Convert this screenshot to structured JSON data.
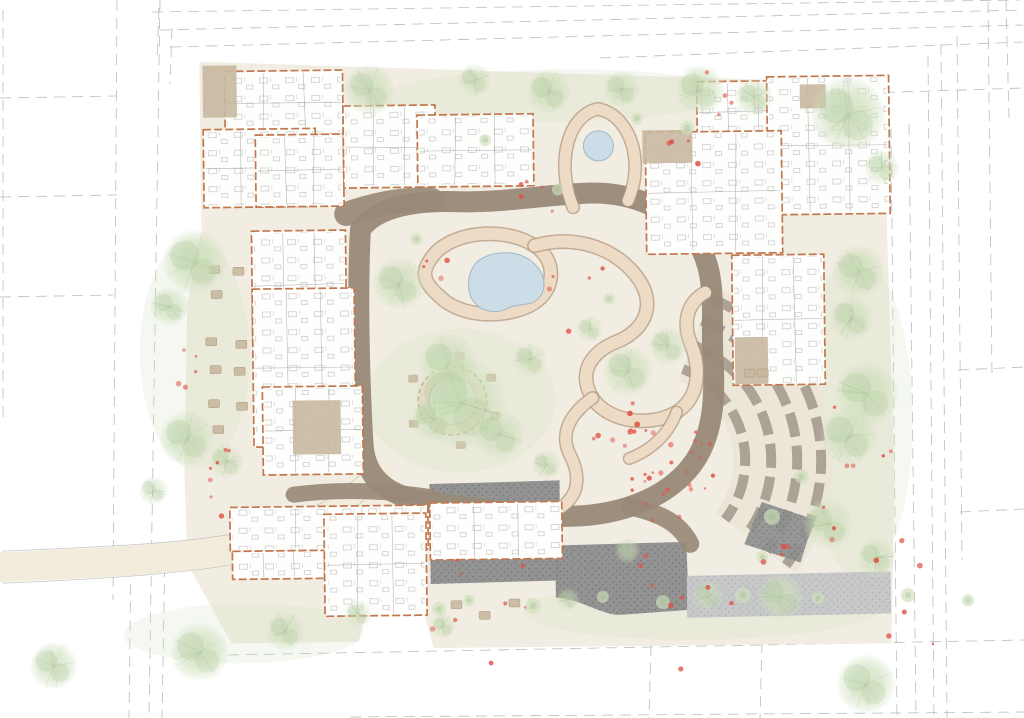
{
  "meta": {
    "description": "Watercolor landscape architecture site plan of a care-home campus with central therapeutic garden",
    "canvas": {
      "width": 1024,
      "height": 718
    }
  },
  "palette": {
    "background": "#ffffff",
    "site_ground": "#f1ece0",
    "ground_wash_green": "#cfe0bf",
    "main_path_brown": "#998977",
    "garden_path_fill": "#eddbc5",
    "garden_path_edge": "#b2957c",
    "building_fill": "#fefefd",
    "building_wall_orange": "#c1784e",
    "patio_tan": "#c8b8a0",
    "water_fill": "#ccdde8",
    "water_edge": "#9db7c6",
    "tree_green": "#cfe0bd",
    "tree_accent": "#9fbe8c",
    "paving_dark": "#8d8e8e",
    "paving_speck": "#5c5c5a",
    "paving_light": "#c5c6c8",
    "terrace_stripe": "#a2958a",
    "terrace_band": "#ece6d9",
    "flower_red": "#e05248",
    "boundary_line": "#a9adad",
    "furniture_line": "#9a9a9a",
    "road_fill": "#f2ecdc",
    "road_edge": "#b8b8b8"
  },
  "site_plan": {
    "boundary_lines": [
      [
        3,
        10,
        3,
        420
      ],
      [
        117,
        0,
        113,
        600
      ],
      [
        160,
        0,
        149,
        718
      ],
      [
        131,
        548,
        129,
        718
      ],
      [
        165,
        548,
        162,
        718
      ],
      [
        0,
        98,
        117,
        96
      ],
      [
        0,
        197,
        117,
        195
      ],
      [
        0,
        297,
        113,
        295
      ],
      [
        152,
        12,
        1020,
        0
      ],
      [
        160,
        30,
        1023,
        10
      ],
      [
        170,
        47,
        1023,
        25
      ],
      [
        600,
        58,
        1023,
        42
      ],
      [
        776,
        96,
        1023,
        88
      ],
      [
        159,
        8,
        157,
        62
      ],
      [
        172,
        28,
        170,
        84
      ],
      [
        891,
        128,
        897,
        718
      ],
      [
        909,
        124,
        916,
        718
      ],
      [
        928,
        56,
        934,
        718
      ],
      [
        941,
        44,
        947,
        718
      ],
      [
        957,
        36,
        962,
        560
      ],
      [
        988,
        2,
        992,
        376
      ],
      [
        1006,
        0,
        1009,
        118
      ],
      [
        958,
        370,
        1024,
        367
      ],
      [
        960,
        512,
        1024,
        509
      ],
      [
        228,
        655,
        1024,
        640
      ],
      [
        350,
        717,
        1024,
        712
      ],
      [
        651,
        645,
        649,
        718
      ],
      [
        762,
        642,
        760,
        718
      ]
    ],
    "ground": {
      "site_polygon": "203,58 886,88 893,478 888,648 430,647 418,600 368,595 355,640 228,640 185,560 183,470 188,300 203,230",
      "road": {
        "fill_path": "M 0,561 C 92,558 190,555 251,542 C 310,528 341,503 375,472",
        "width": 30,
        "edges": [
          "M 0,545 C 90,542 185,540 245,528 C 305,515 338,492 372,462",
          "M 0,577 C 95,574 195,570 258,556 C 315,542 345,515 378,483"
        ]
      },
      "washes": [
        [
          460,
          400,
          95,
          72
        ],
        [
          195,
          350,
          55,
          115
        ],
        [
          857,
          420,
          55,
          160
        ],
        [
          700,
          612,
          180,
          30
        ],
        [
          560,
          96,
          175,
          26
        ],
        [
          240,
          630,
          120,
          30
        ]
      ]
    },
    "main_loop": {
      "path": "M 362,228 C 358,290 359,380 362,442 C 364,482 393,498 438,503 C 482,508 520,516 562,517 C 612,518 662,503 690,468 C 712,440 715,402 713,362 C 711,322 719,282 701,248 C 684,216 637,193 592,194 C 547,195 505,203 458,201 C 416,199 377,206 362,228",
      "width": 21,
      "spurs": [
        {
          "d": "M 348,212 C 380,201 408,197 434,199",
          "width": 24
        },
        {
          "d": "M 292,492 C 340,486 390,490 428,496",
          "width": 16
        },
        {
          "d": "M 628,508 C 660,515 678,526 688,546",
          "width": 18
        }
      ]
    },
    "garden_paths": [
      {
        "d": "M 432,258 C 450,230 506,226 536,246 C 560,262 556,294 530,306 C 502,319 462,316 442,297 C 424,281 422,272 432,258",
        "width": 12
      },
      {
        "d": "M 536,246 C 580,234 622,252 641,283 C 657,309 643,333 617,343 C 591,353 577,374 592,399 C 608,424 651,429 676,414 C 699,400 701,371 691,346 C 683,326 687,305 706,295",
        "width": 12
      },
      {
        "d": "M 592,399 C 570,414 558,434 569,456 C 580,478 577,498 556,510",
        "width": 11
      },
      {
        "d": "M 575,208 C 558,165 570,116 601,110 C 632,116 648,162 630,202",
        "width": 11
      },
      {
        "d": "M 676,414 C 668,436 650,452 628,460",
        "width": 10
      }
    ],
    "garden_ring": {
      "cx": 452,
      "cy": 400,
      "r": 29
    },
    "ponds": {
      "main": "M 480,260 C 495,250 518,250 532,261 C 546,272 549,289 539,299 C 531,307 519,303 509,308 C 497,314 483,312 475,302 C 466,291 468,270 480,260 Z",
      "small": {
        "cx": 601,
        "cy": 147,
        "r": 15
      }
    },
    "terraces": {
      "cx": 646,
      "cy": 462,
      "radii": [
        98,
        124,
        150,
        174
      ],
      "start_deg": -68,
      "end_deg": 38,
      "band_r": 136,
      "band_width": 100,
      "wedge": "760,505 812,523 798,566 742,547"
    },
    "paving": [
      {
        "kind": "dark",
        "d": "M 553,546 L 684,544 L 686,612 L 620,616 C 600,618 580,600 553,598 Z"
      },
      {
        "kind": "dark",
        "d": "M 428,483 L 558,481 L 558,505 L 428,507 Z"
      },
      {
        "kind": "dark",
        "d": "M 428,557 L 556,555 L 556,581 L 428,583 Z"
      },
      {
        "kind": "light",
        "d": "M 684,578 L 888,576 L 888,618 L 684,620 Z"
      }
    ],
    "buildings": [
      {
        "name": "northwest-wing-a",
        "rect": [
          228,
          68,
          118,
          64
        ]
      },
      {
        "name": "northwest-wing-b",
        "rect": [
          206,
          126,
          112,
          78
        ]
      },
      {
        "name": "northwest-wing-c",
        "rect": [
          258,
          132,
          88,
          72
        ]
      },
      {
        "name": "northwest-wing-d",
        "rect": [
          346,
          104,
          92,
          82
        ]
      },
      {
        "name": "north-strip-building",
        "rect": [
          420,
          114,
          116,
          72
        ]
      },
      {
        "name": "northeast-wing-a",
        "rect": [
          700,
          84,
          92,
          62
        ]
      },
      {
        "name": "northeast-wing-b",
        "rect": [
          770,
          80,
          122,
          138
        ]
      },
      {
        "name": "northeast-wing-c",
        "rect": [
          648,
          134,
          136,
          122
        ]
      },
      {
        "name": "east-villa",
        "rect": [
          733,
          258,
          92,
          130
        ]
      },
      {
        "name": "west-long-wing-a",
        "rect": [
          253,
          228,
          94,
          110
        ]
      },
      {
        "name": "west-long-wing-b",
        "rect": [
          253,
          286,
          102,
          158
        ]
      },
      {
        "name": "west-courtyard-building",
        "rect": [
          262,
          384,
          100,
          88
        ]
      },
      {
        "name": "south-strip-a",
        "rect": [
          228,
          504,
          198,
          44
        ]
      },
      {
        "name": "south-strip-b",
        "rect": [
          230,
          548,
          92,
          28
        ]
      },
      {
        "name": "south-hall",
        "rect": [
          322,
          512,
          102,
          102
        ]
      },
      {
        "name": "south-east-building",
        "rect": [
          428,
          502,
          132,
          57
        ]
      }
    ],
    "patios": [
      [
        206,
        62,
        34,
        52
      ],
      [
        645,
        132,
        50,
        33
      ],
      [
        803,
        88,
        26,
        24
      ],
      [
        292,
        398,
        48,
        54
      ],
      [
        735,
        340,
        33,
        47
      ]
    ],
    "outdoor_furniture": [
      [
        210,
        262
      ],
      [
        234,
        264
      ],
      [
        212,
        287
      ],
      [
        206,
        334
      ],
      [
        236,
        337
      ],
      [
        210,
        362
      ],
      [
        234,
        364
      ],
      [
        208,
        396
      ],
      [
        236,
        399
      ],
      [
        212,
        422
      ],
      [
        448,
        600
      ],
      [
        476,
        611
      ],
      [
        506,
        599
      ],
      [
        744,
        372
      ],
      [
        757,
        372
      ]
    ],
    "ring_benches_angles": [
      20,
      80,
      150,
      210,
      280,
      330
    ],
    "trees": [
      [
        373,
        88,
        26,
        0.9
      ],
      [
        478,
        80,
        17,
        0.75
      ],
      [
        552,
        92,
        23,
        0.9
      ],
      [
        625,
        90,
        19,
        0.8
      ],
      [
        703,
        92,
        25,
        0.9
      ],
      [
        757,
        100,
        19,
        0.8
      ],
      [
        851,
        118,
        38,
        0.95
      ],
      [
        884,
        172,
        18,
        0.7
      ],
      [
        196,
        258,
        33,
        0.95
      ],
      [
        170,
        302,
        20,
        0.8
      ],
      [
        186,
        434,
        28,
        0.9
      ],
      [
        225,
        458,
        18,
        0.7
      ],
      [
        152,
        486,
        15,
        0.6
      ],
      [
        400,
        282,
        27,
        0.9
      ],
      [
        448,
        362,
        30,
        0.9
      ],
      [
        460,
        402,
        48,
        0.95
      ],
      [
        498,
        434,
        26,
        0.85
      ],
      [
        432,
        418,
        22,
        0.8
      ],
      [
        530,
        360,
        18,
        0.7
      ],
      [
        590,
        330,
        14,
        0.6
      ],
      [
        628,
        372,
        26,
        0.85
      ],
      [
        668,
        348,
        20,
        0.75
      ],
      [
        545,
        465,
        15,
        0.7
      ],
      [
        860,
        275,
        27,
        0.9
      ],
      [
        852,
        322,
        23,
        0.85
      ],
      [
        866,
        398,
        33,
        0.95
      ],
      [
        848,
        440,
        30,
        0.9
      ],
      [
        826,
        528,
        26,
        0.85
      ],
      [
        874,
        562,
        20,
        0.8
      ],
      [
        778,
        600,
        24,
        0.85
      ],
      [
        862,
        688,
        30,
        0.9
      ],
      [
        196,
        648,
        30,
        0.9
      ],
      [
        282,
        628,
        20,
        0.8
      ],
      [
        50,
        660,
        24,
        0.85
      ],
      [
        355,
        612,
        14,
        0.6
      ],
      [
        440,
        625,
        13,
        0.7
      ],
      [
        565,
        600,
        12,
        0.6
      ],
      [
        625,
        552,
        13,
        0.65
      ],
      [
        705,
        598,
        16,
        0.7
      ]
    ],
    "shrubs": [
      [
        436,
        608,
        7
      ],
      [
        466,
        600,
        6
      ],
      [
        530,
        606,
        8
      ],
      [
        600,
        598,
        6
      ],
      [
        660,
        604,
        7
      ],
      [
        740,
        598,
        8
      ],
      [
        815,
        602,
        6
      ],
      [
        905,
        600,
        7
      ],
      [
        965,
        606,
        6
      ],
      [
        770,
        520,
        8
      ],
      [
        800,
        480,
        7
      ],
      [
        760,
        560,
        6
      ],
      [
        690,
        130,
        7
      ],
      [
        640,
        120,
        6
      ],
      [
        560,
        190,
        6
      ],
      [
        488,
        140,
        6
      ],
      [
        418,
        238,
        6
      ],
      [
        610,
        300,
        6
      ]
    ],
    "flower_clusters": [
      {
        "cx": 660,
        "cy": 470,
        "spread": 55,
        "count": 26
      },
      {
        "cx": 620,
        "cy": 430,
        "spread": 30,
        "count": 10
      },
      {
        "cx": 700,
        "cy": 120,
        "spread": 60,
        "count": 8
      },
      {
        "cx": 540,
        "cy": 195,
        "spread": 25,
        "count": 5
      },
      {
        "cx": 230,
        "cy": 480,
        "spread": 40,
        "count": 7
      },
      {
        "cx": 190,
        "cy": 360,
        "spread": 30,
        "count": 5
      },
      {
        "cx": 700,
        "cy": 600,
        "spread": 85,
        "count": 10
      },
      {
        "cx": 900,
        "cy": 605,
        "spread": 60,
        "count": 6
      },
      {
        "cx": 480,
        "cy": 610,
        "spread": 60,
        "count": 8
      },
      {
        "cx": 800,
        "cy": 530,
        "spread": 40,
        "count": 6
      },
      {
        "cx": 420,
        "cy": 260,
        "spread": 30,
        "count": 4
      },
      {
        "cx": 580,
        "cy": 300,
        "spread": 40,
        "count": 5
      },
      {
        "cx": 860,
        "cy": 440,
        "spread": 40,
        "count": 5
      }
    ]
  }
}
